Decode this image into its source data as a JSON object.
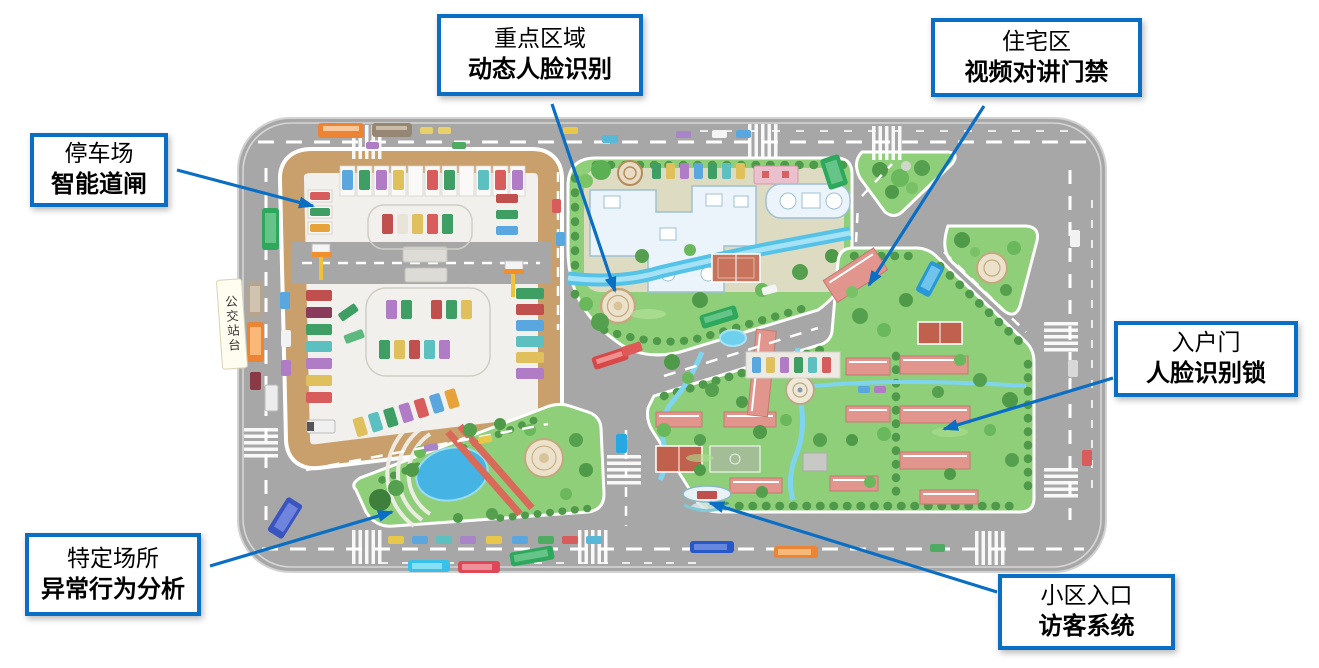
{
  "colors": {
    "callout_border": "#0a6fc4",
    "road": "#a7a7a7",
    "grass": "#90cf7a",
    "water": "#55c2e8",
    "building_roof": "#e2958c",
    "parking_border": "#c9a06b"
  },
  "callouts": [
    {
      "name": "key-area",
      "line1": "重点区域",
      "line2": "动态人脸识别"
    },
    {
      "name": "residential-area",
      "line1": "住宅区",
      "line2": "视频对讲门禁"
    },
    {
      "name": "parking",
      "line1": "停车场",
      "line2": "智能道闸"
    },
    {
      "name": "entry-door",
      "line1": "入户门",
      "line2": "人脸识别锁"
    },
    {
      "name": "special-place",
      "line1": "特定场所",
      "line2": "异常行为分析"
    },
    {
      "name": "community-entrance",
      "line1": "小区入口",
      "line2": "访客系统"
    }
  ],
  "map": {
    "bus_stop_label": "公交站台"
  }
}
